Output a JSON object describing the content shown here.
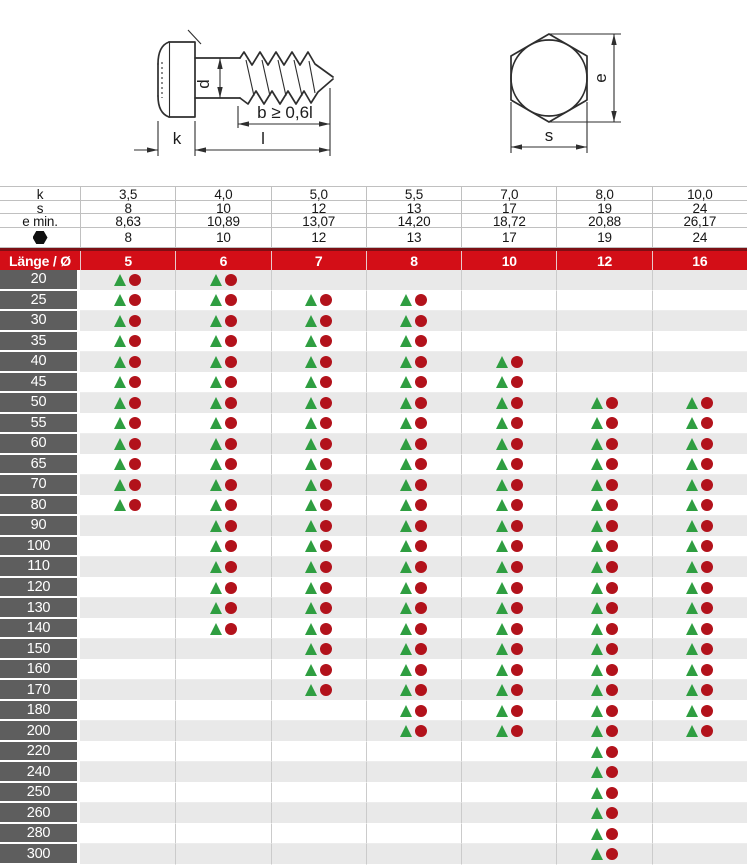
{
  "drawing": {
    "screw_view": {
      "d_label": "d",
      "b_label": "b ≥ 0,6l",
      "k_label": "k",
      "l_label": "l"
    },
    "head_view": {
      "e_label": "e",
      "s_label": "s"
    }
  },
  "table": {
    "spec_rows": [
      {
        "id": "k",
        "label": "k",
        "icon": false,
        "values": [
          "3,5",
          "4,0",
          "5,0",
          "5,5",
          "7,0",
          "8,0",
          "10,0"
        ]
      },
      {
        "id": "s",
        "label": "s",
        "icon": false,
        "values": [
          "8",
          "10",
          "12",
          "13",
          "17",
          "19",
          "24"
        ]
      },
      {
        "id": "e-min",
        "label": "e min.",
        "icon": false,
        "values": [
          "8,63",
          "10,89",
          "13,07",
          "14,20",
          "18,72",
          "20,88",
          "26,17"
        ]
      },
      {
        "id": "sw",
        "label": "",
        "icon": true,
        "values": [
          "8",
          "10",
          "12",
          "13",
          "17",
          "19",
          "24"
        ]
      }
    ],
    "diameter_header": {
      "label": "Länge / Ø",
      "values": [
        "5",
        "6",
        "7",
        "8",
        "10",
        "12",
        "16"
      ]
    },
    "length_rows": [
      {
        "length": "20",
        "available": [
          1,
          1,
          0,
          0,
          0,
          0,
          0
        ]
      },
      {
        "length": "25",
        "available": [
          1,
          1,
          1,
          1,
          0,
          0,
          0
        ]
      },
      {
        "length": "30",
        "available": [
          1,
          1,
          1,
          1,
          0,
          0,
          0
        ]
      },
      {
        "length": "35",
        "available": [
          1,
          1,
          1,
          1,
          0,
          0,
          0
        ]
      },
      {
        "length": "40",
        "available": [
          1,
          1,
          1,
          1,
          1,
          0,
          0
        ]
      },
      {
        "length": "45",
        "available": [
          1,
          1,
          1,
          1,
          1,
          0,
          0
        ]
      },
      {
        "length": "50",
        "available": [
          1,
          1,
          1,
          1,
          1,
          1,
          1
        ]
      },
      {
        "length": "55",
        "available": [
          1,
          1,
          1,
          1,
          1,
          1,
          1
        ]
      },
      {
        "length": "60",
        "available": [
          1,
          1,
          1,
          1,
          1,
          1,
          1
        ]
      },
      {
        "length": "65",
        "available": [
          1,
          1,
          1,
          1,
          1,
          1,
          1
        ]
      },
      {
        "length": "70",
        "available": [
          1,
          1,
          1,
          1,
          1,
          1,
          1
        ]
      },
      {
        "length": "80",
        "available": [
          1,
          1,
          1,
          1,
          1,
          1,
          1
        ]
      },
      {
        "length": "90",
        "available": [
          0,
          1,
          1,
          1,
          1,
          1,
          1
        ]
      },
      {
        "length": "100",
        "available": [
          0,
          1,
          1,
          1,
          1,
          1,
          1
        ]
      },
      {
        "length": "110",
        "available": [
          0,
          1,
          1,
          1,
          1,
          1,
          1
        ]
      },
      {
        "length": "120",
        "available": [
          0,
          1,
          1,
          1,
          1,
          1,
          1
        ]
      },
      {
        "length": "130",
        "available": [
          0,
          1,
          1,
          1,
          1,
          1,
          1
        ]
      },
      {
        "length": "140",
        "available": [
          0,
          1,
          1,
          1,
          1,
          1,
          1
        ]
      },
      {
        "length": "150",
        "available": [
          0,
          0,
          1,
          1,
          1,
          1,
          1
        ]
      },
      {
        "length": "160",
        "available": [
          0,
          0,
          1,
          1,
          1,
          1,
          1
        ]
      },
      {
        "length": "170",
        "available": [
          0,
          0,
          1,
          1,
          1,
          1,
          1
        ]
      },
      {
        "length": "180",
        "available": [
          0,
          0,
          0,
          1,
          1,
          1,
          1
        ]
      },
      {
        "length": "200",
        "available": [
          0,
          0,
          0,
          1,
          1,
          1,
          1
        ]
      },
      {
        "length": "220",
        "available": [
          0,
          0,
          0,
          0,
          0,
          1,
          0
        ]
      },
      {
        "length": "240",
        "available": [
          0,
          0,
          0,
          0,
          0,
          1,
          0
        ]
      },
      {
        "length": "250",
        "available": [
          0,
          0,
          0,
          0,
          0,
          1,
          0
        ]
      },
      {
        "length": "260",
        "available": [
          0,
          0,
          0,
          0,
          0,
          1,
          0
        ]
      },
      {
        "length": "280",
        "available": [
          0,
          0,
          0,
          0,
          0,
          1,
          0
        ]
      },
      {
        "length": "300",
        "available": [
          0,
          0,
          0,
          0,
          0,
          1,
          0
        ]
      }
    ]
  },
  "colors": {
    "header_red": "#d30e17",
    "header_red_dark": "#7c0f14",
    "label_gray": "#5e5e5e",
    "row_gray": "#e9e9e9",
    "grid_line": "#c0c0c0",
    "marker_green": "#2f9e41",
    "marker_red": "#b2121b"
  }
}
